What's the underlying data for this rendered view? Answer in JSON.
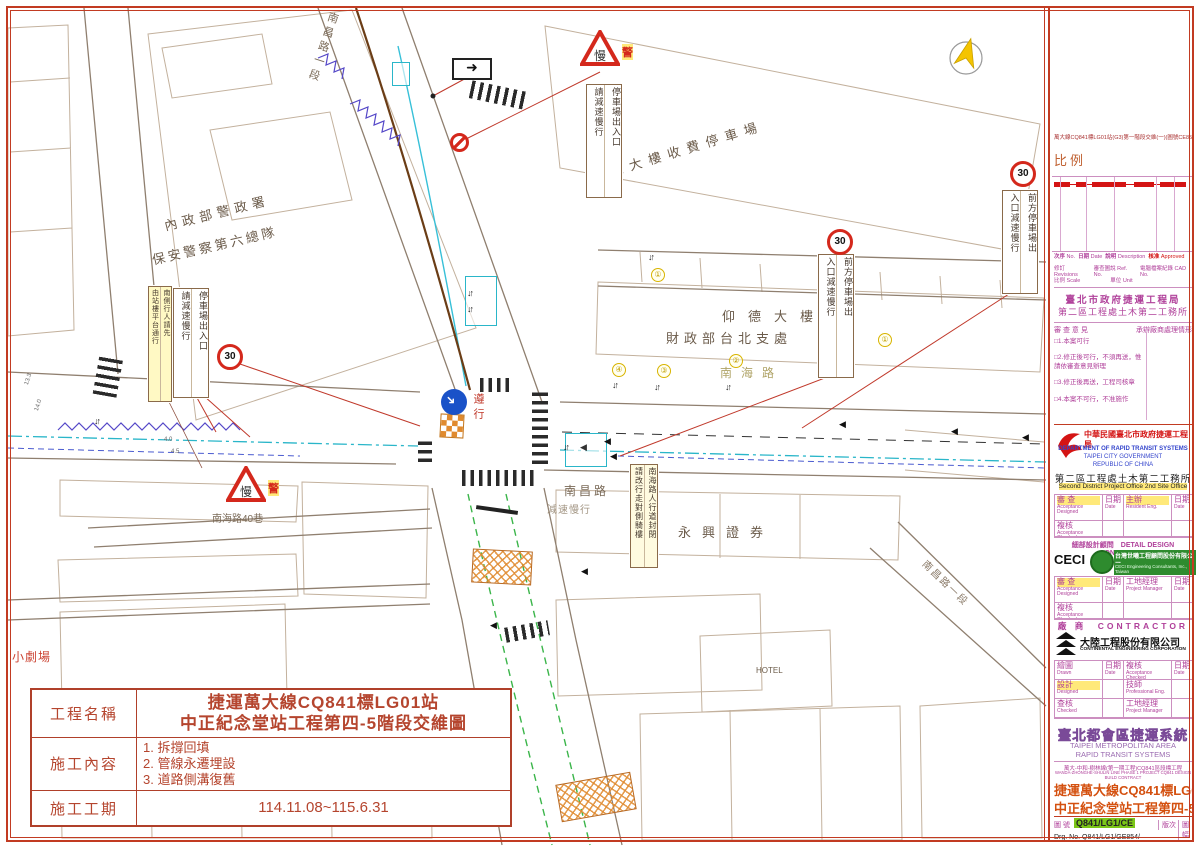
{
  "map": {
    "building_labels": [
      {
        "t": "內政部警政署",
        "x": 162,
        "y": 216,
        "rot": -14,
        "ls": 5,
        "fs": 13,
        "color": "#6b5b4a"
      },
      {
        "t": "保安警察第六總隊",
        "x": 150,
        "y": 250,
        "rot": -13,
        "ls": 3,
        "fs": 13,
        "color": "#6b5b4a"
      },
      {
        "t": "仰德大樓收費停車場",
        "x": 588,
        "y": 168,
        "rot": -17,
        "ls": 7,
        "fs": 13,
        "color": "#6b5b4a"
      },
      {
        "t": "仰德大樓",
        "x": 722,
        "y": 306,
        "ls": 13,
        "fs": 13,
        "color": "#6b5b4a"
      },
      {
        "t": "財政部台北支處",
        "x": 666,
        "y": 328,
        "ls": 5,
        "fs": 13,
        "color": "#6b5b4a"
      },
      {
        "t": "永興證券",
        "x": 678,
        "y": 522,
        "ls": 11,
        "fs": 13,
        "color": "#6b5b4a"
      },
      {
        "t": "HOTEL",
        "x": 756,
        "y": 666,
        "ls": 0,
        "fs": 8,
        "color": "#6b5b4a"
      }
    ],
    "street_labels": [
      {
        "t": "南海路",
        "x": 720,
        "y": 364,
        "ls": 9,
        "fs": 12,
        "color": "#b0a468"
      },
      {
        "t": "南昌路",
        "x": 564,
        "y": 482,
        "ls": 3,
        "fs": 12,
        "color": "#7a6a58"
      },
      {
        "t": "減速慢行",
        "x": 547,
        "y": 501,
        "ls": 1,
        "fs": 10,
        "color": "#a39684"
      },
      {
        "t": "南海路40巷",
        "x": 212,
        "y": 510,
        "ls": 0,
        "fs": 10,
        "color": "#7a6a58"
      },
      {
        "t": "小劇場",
        "x": 12,
        "y": 648,
        "ls": 1,
        "fs": 12,
        "color": "#cc4433"
      },
      {
        "t": "南昌路一段",
        "x": 930,
        "y": 556,
        "rot": 44,
        "ls": 2,
        "fs": 10,
        "color": "#8a7a68"
      }
    ],
    "street_vertical": {
      "t": "南昌路一段",
      "x": 326,
      "y": 12
    },
    "sign_boxes": [
      {
        "right": "停車場出入口",
        "left": "請減速慢行",
        "x": 586,
        "y": 84,
        "h": 112
      },
      {
        "right": "前方停車場出",
        "left": "入口減速慢行",
        "x": 1002,
        "y": 190,
        "h": 102
      },
      {
        "right": "前方停車場出",
        "left": "入口減速慢行",
        "x": 818,
        "y": 254,
        "h": 122
      },
      {
        "right": "停車場出入口",
        "left": "請減速慢行",
        "x": 173,
        "y": 288,
        "h": 108
      },
      {
        "right": "南側行人請先",
        "left": "由站樓平台通行",
        "x": 148,
        "y": 286,
        "h": 114,
        "w": 22,
        "fs": 7,
        "bg": "#fff9c4"
      },
      {
        "right": "南海路人行道封閉",
        "left": "請改行走對側騎樓",
        "x": 630,
        "y": 464,
        "h": 102,
        "w": 26,
        "fs": 8,
        "bg": "#fffbe0"
      }
    ],
    "speed_signs": [
      {
        "v": "30",
        "x": 1010,
        "y": 161
      },
      {
        "v": "30",
        "x": 827,
        "y": 229
      },
      {
        "v": "30",
        "x": 217,
        "y": 344
      }
    ],
    "warn_triangles": [
      {
        "glyph": "慢",
        "badge": "警",
        "x": 580,
        "y": 30
      },
      {
        "glyph": "慢",
        "badge": "警",
        "x": 226,
        "y": 466
      }
    ],
    "keep_right_label": "遵行",
    "lane_numbers": [
      {
        "v": "①",
        "x": 651,
        "y": 268
      },
      {
        "v": "④",
        "x": 612,
        "y": 363
      },
      {
        "v": "③",
        "x": 657,
        "y": 364
      },
      {
        "v": "②",
        "x": 729,
        "y": 354
      },
      {
        "v": "①",
        "x": 878,
        "y": 333
      }
    ],
    "updown_markers": [
      {
        "v": "↓↑",
        "x": 648,
        "y": 252
      },
      {
        "v": "↓↑",
        "x": 612,
        "y": 380
      },
      {
        "v": "↓↑",
        "x": 654,
        "y": 382
      },
      {
        "v": "↓↑",
        "x": 725,
        "y": 382
      },
      {
        "v": "↓↑",
        "x": 467,
        "y": 288
      },
      {
        "v": "↓↑",
        "x": 467,
        "y": 304
      },
      {
        "v": "↓↑",
        "x": 563,
        "y": 442
      },
      {
        "v": "↓↑",
        "x": 94,
        "y": 416
      }
    ],
    "dir_arrows": [
      {
        "v": "◀",
        "x": 604,
        "y": 436
      },
      {
        "v": "◀",
        "x": 610,
        "y": 451
      },
      {
        "v": "◀",
        "x": 839,
        "y": 419
      },
      {
        "v": "◀",
        "x": 951,
        "y": 426
      },
      {
        "v": "◀",
        "x": 1022,
        "y": 432
      },
      {
        "v": "◀",
        "x": 581,
        "y": 566
      },
      {
        "v": "◀",
        "x": 490,
        "y": 620
      }
    ],
    "dims": [
      {
        "t": "13.3",
        "x": 24,
        "y": 384,
        "rot": -72
      },
      {
        "t": "14.0",
        "x": 34,
        "y": 410,
        "rot": -72
      },
      {
        "t": "4.0",
        "x": 164,
        "y": 437,
        "rot": 0
      },
      {
        "t": "4.5",
        "x": 171,
        "y": 449,
        "rot": 0
      }
    ],
    "oneway_arrow": "➜"
  },
  "title_block": {
    "name_label": "工程名稱",
    "name_line1": "捷運萬大線CQ841標LG01站",
    "name_line2": "中正紀念堂站工程第四-5階段交維圖",
    "content_label": "施工內容",
    "content_items": [
      "1. 拆撐回填",
      "2. 管線永遷埋設",
      "3. 道路側溝復舊"
    ],
    "period_label": "施工工期",
    "period_value": "114.11.08~115.6.31"
  },
  "side_panel": {
    "ref_note": "萬大線CQ841標LG01站(G3)第一階段交維(一)(圖號CE854-1)之詳圖",
    "scale_label": "比例",
    "rev_footer": {
      "c1": "次序",
      "c1e": "No.",
      "c2": "日期",
      "c2e": "Date",
      "c3": "說明",
      "c3e": "Description",
      "c4": "核准",
      "c4e": "Approved",
      "r2a": "修訂 Revisions",
      "r2b": "審查圖說 Ref. No.",
      "r2c": "電腦檔案紀錄 CAD No.",
      "r3a": "比例 Scale",
      "r3b": "單位 Unit"
    },
    "review": {
      "title1": "臺北市政府捷運工程局",
      "title2": "第二區工程處土木第二工務所",
      "col1": "審 查 意 見",
      "col2": "承辦廠商處理情形",
      "items": [
        "□1.本案可行",
        "□2.修正後可行，不須再送，惟請依審查意見辦理",
        "□3.修正後再送，工程司核章",
        "□4.本案不可行，不准施作"
      ]
    },
    "drts": {
      "cn": "中華民國臺北市政府捷運工程局",
      "en1": "DEPARTMENT  OF  RAPID  TRANSIT  SYSTEMS",
      "en2": "TAIPEI  CITY  GOVERNMENT",
      "en3": "REPUBLIC  OF  CHINA",
      "office_cn": "第二區工程處土木第二工務所",
      "office_en": "Second District Project Office 2nd Site Office"
    },
    "grid1": [
      {
        "cn": "審 查",
        "en": "Acceptance Designed",
        "w": 48,
        "h": 26,
        "hl": 1
      },
      {
        "cn": "日期",
        "en": "Date",
        "w": 21,
        "h": 26
      },
      {
        "cn": "主辦",
        "en": "Resident Eng.",
        "w": 48,
        "h": 26,
        "hl": 1
      },
      {
        "cn": "日期",
        "en": "Date",
        "w": 21,
        "h": 26
      },
      {
        "cn": "複核",
        "en": "Acceptance Checked",
        "w": 48,
        "h": 16
      },
      {
        "cn": "",
        "en": "",
        "w": 21,
        "h": 16
      },
      {
        "cn": "",
        "en": "",
        "w": 48,
        "h": 16
      },
      {
        "cn": "",
        "en": "",
        "w": 21,
        "h": 16
      }
    ],
    "consultant_hdr": "細部設計顧問　DETAIL DESIGN CONSULTANT",
    "ceci": {
      "abbr": "CECI",
      "cn": "台灣世曦工程顧問股份有限公司",
      "en": "CECI Engineering Consultants, Inc., Taiwan"
    },
    "grid2": [
      {
        "cn": "審 查",
        "en": "Acceptance Designed",
        "w": 48,
        "h": 26,
        "hl": 1
      },
      {
        "cn": "日期",
        "en": "Date",
        "w": 21,
        "h": 26
      },
      {
        "cn": "工地經理",
        "en": "Project Manager",
        "w": 48,
        "h": 26
      },
      {
        "cn": "日期",
        "en": "Date",
        "w": 21,
        "h": 26
      },
      {
        "cn": "複核",
        "en": "Acceptance Checked",
        "w": 48,
        "h": 16
      },
      {
        "cn": "",
        "en": "",
        "w": 21,
        "h": 16
      },
      {
        "cn": "",
        "en": "",
        "w": 48,
        "h": 16
      },
      {
        "cn": "",
        "en": "",
        "w": 21,
        "h": 16
      }
    ],
    "contractor_hdr": "廠 商　CONTRACTOR",
    "cec": {
      "cn": "大陸工程股份有限公司",
      "en": "CONTINENTAL ENGINEERING CORPORATION"
    },
    "grid3": [
      {
        "cn": "繪圖",
        "en": "Drawn",
        "w": 48,
        "h": 19
      },
      {
        "cn": "日期",
        "en": "Date",
        "w": 21,
        "h": 19
      },
      {
        "cn": "複核",
        "en": "Acceptance Checked",
        "w": 48,
        "h": 19
      },
      {
        "cn": "日期",
        "en": "Date",
        "w": 21,
        "h": 19
      },
      {
        "cn": "設計",
        "en": "Designed",
        "w": 48,
        "h": 19,
        "hl": 1
      },
      {
        "cn": "",
        "en": "",
        "w": 21,
        "h": 19
      },
      {
        "cn": "技師",
        "en": "Professional Eng.",
        "w": 48,
        "h": 19
      },
      {
        "cn": "",
        "en": "",
        "w": 21,
        "h": 19
      },
      {
        "cn": "查核",
        "en": "Checked",
        "w": 48,
        "h": 19
      },
      {
        "cn": "",
        "en": "",
        "w": 21,
        "h": 19
      },
      {
        "cn": "工地經理",
        "en": "Project Manager",
        "w": 48,
        "h": 19
      },
      {
        "cn": "",
        "en": "",
        "w": 21,
        "h": 19
      }
    ],
    "system": {
      "cn": "臺北都會區捷運系統",
      "en1": "TAIPEI  METROPOLITAN  AREA",
      "en2": "RAPID  TRANSIT  SYSTEMS"
    },
    "project": {
      "cn": "萬大-中和-樹林線(第一期工程)CQ841區段標工程",
      "en": "WANDA-ZHONGHE-SHULIN LINE PHASE 1 PROJECT CQ841 DESIGN BUILD CONTRACT"
    },
    "drawing_title1": "捷運萬大線CQ841標LG01站",
    "drawing_title2": "中正紀念堂站工程第四-5階段交維圖",
    "drg": {
      "label": "圖 號",
      "no_hl": "Q841/LG1/CE",
      "no_full": "Drg. No.  Q841/LG1/GE854/",
      "rev": "版次",
      "size": "圖幅"
    }
  }
}
